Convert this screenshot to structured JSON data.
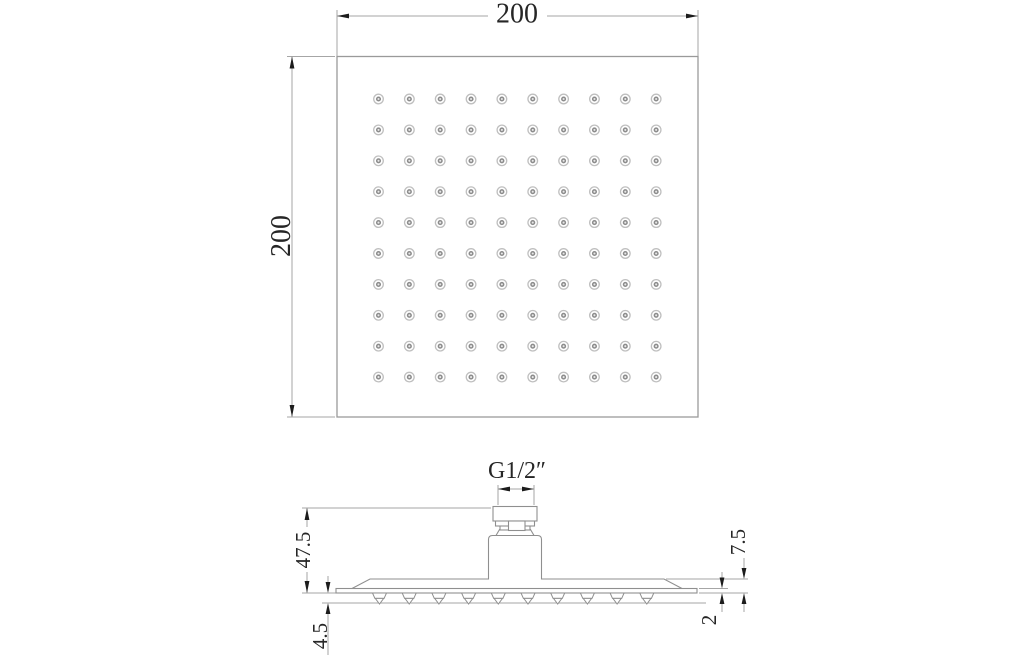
{
  "drawing": {
    "type": "technical-drawing-square-rain-shower-head",
    "front": {
      "width_dim": "200",
      "height_dim": "200",
      "nozzle_rows": 10,
      "nozzle_cols": 10
    },
    "side": {
      "thread_dim": "G1/2″",
      "height_dim": "47.5",
      "nozzle_height_dim": "4.5",
      "edge_height_dim": "7.5",
      "plate_thickness_dim": "2",
      "nozzle_count": 10
    },
    "colors": {
      "background": "#ffffff",
      "outline": "#8f8f8f",
      "dim_line": "#a6a6a6",
      "arrow": "#1c1c1c",
      "text": "#262626",
      "nozzle_ring": "#bfbfbf",
      "nozzle_dot": "#8c8c8c"
    }
  }
}
